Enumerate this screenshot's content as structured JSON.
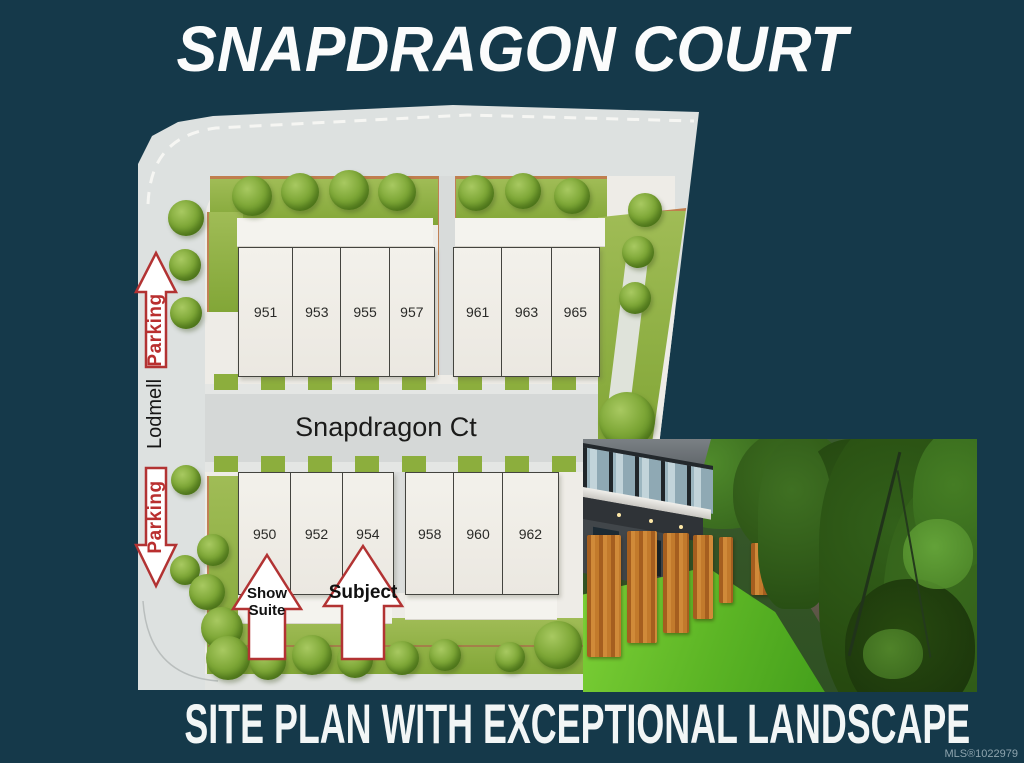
{
  "poster": {
    "title": "SNAPDRAGON COURT",
    "caption": "SITE PLAN WITH EXCEPTIONAL LANDSCAPE",
    "mls": "MLS®1022979"
  },
  "site_plan": {
    "streets": {
      "court": "Snapdragon Ct",
      "side_street": "Lodmell"
    },
    "parking_label": "Parking",
    "annotations": {
      "show_suite": "Show\nSuite",
      "subject": "Subject"
    },
    "blocks": [
      {
        "id": "upper-left",
        "units": [
          "951",
          "953",
          "955",
          "957"
        ]
      },
      {
        "id": "upper-right",
        "units": [
          "961",
          "963",
          "965"
        ]
      },
      {
        "id": "lower-left",
        "units": [
          "950",
          "952",
          "954"
        ]
      },
      {
        "id": "lower-right",
        "units": [
          "958",
          "960",
          "962"
        ]
      }
    ]
  },
  "colors": {
    "background": "#15394a",
    "arrow_red": "#b23333",
    "grass_green": "#8cae3d",
    "road_gray": "#dde1e0"
  }
}
